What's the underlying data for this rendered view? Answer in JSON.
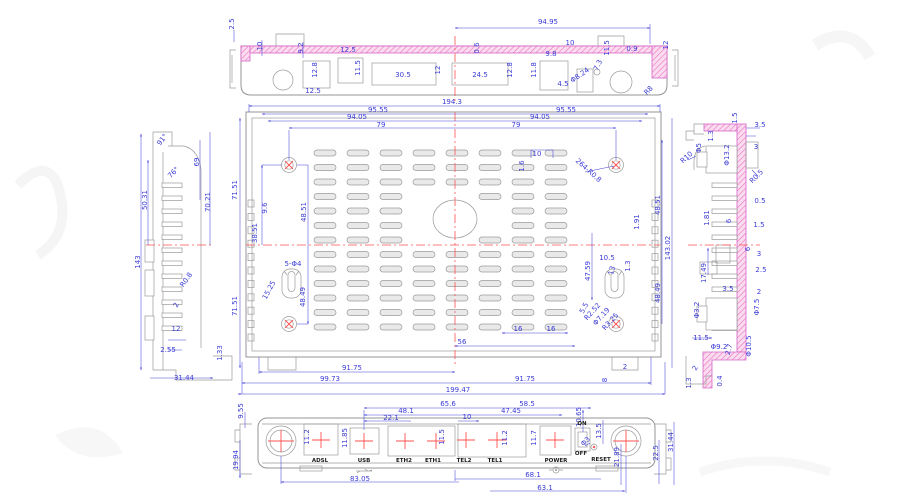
{
  "drawing_title": "router-enclosure-multiview-cad-drawing",
  "colors": {
    "dimension": "#3b3bd6",
    "outline": "#9a9a9a",
    "section_hatch": "#e86ac4",
    "centerline": "#ff5252"
  },
  "views": {
    "top_view": {
      "labels": [
        {
          "t": "2.5",
          "x": 234,
          "y": 24,
          "r": -90
        },
        {
          "t": "10",
          "x": 262,
          "y": 46,
          "r": -90
        },
        {
          "t": "9.2",
          "x": 303,
          "y": 48,
          "r": -90
        },
        {
          "t": "12.5",
          "x": 348,
          "y": 52
        },
        {
          "t": "12.8",
          "x": 317,
          "y": 70,
          "r": -90
        },
        {
          "t": "12.5",
          "x": 313,
          "y": 93
        },
        {
          "t": "11.5",
          "x": 360,
          "y": 68,
          "r": -90
        },
        {
          "t": "30.5",
          "x": 403,
          "y": 77
        },
        {
          "t": "12",
          "x": 440,
          "y": 70,
          "r": -90
        },
        {
          "t": "24.5",
          "x": 480,
          "y": 77
        },
        {
          "t": "12.8",
          "x": 512,
          "y": 70,
          "r": -90
        },
        {
          "t": "0.6",
          "x": 479,
          "y": 48,
          "r": -90
        },
        {
          "t": "94.95",
          "x": 548,
          "y": 24
        },
        {
          "t": "10",
          "x": 570,
          "y": 45
        },
        {
          "t": "9.8",
          "x": 551,
          "y": 56
        },
        {
          "t": "11.8",
          "x": 536,
          "y": 70,
          "r": -90
        },
        {
          "t": "11.5",
          "x": 609,
          "y": 48,
          "r": -90
        },
        {
          "t": "0.9",
          "x": 632,
          "y": 51
        },
        {
          "t": "12",
          "x": 668,
          "y": 45,
          "r": -90
        },
        {
          "t": "7.3",
          "x": 600,
          "y": 66,
          "r": -65
        },
        {
          "t": "4.5",
          "x": 563,
          "y": 86
        },
        {
          "t": "Φ8.24",
          "x": 581,
          "y": 77,
          "r": -35
        },
        {
          "t": "R8",
          "x": 650,
          "y": 92,
          "r": -45
        }
      ]
    },
    "main_view": {
      "labels": [
        {
          "t": "194.3",
          "x": 452,
          "y": 104
        },
        {
          "t": "95.55",
          "x": 378,
          "y": 112
        },
        {
          "t": "95.55",
          "x": 566,
          "y": 112
        },
        {
          "t": "94.05",
          "x": 357,
          "y": 119
        },
        {
          "t": "94.05",
          "x": 540,
          "y": 119
        },
        {
          "t": "79",
          "x": 381,
          "y": 127
        },
        {
          "t": "79",
          "x": 516,
          "y": 127
        },
        {
          "t": "10",
          "x": 537,
          "y": 156
        },
        {
          "t": "1.6",
          "x": 524,
          "y": 166,
          "r": -90
        },
        {
          "t": "264-R0.8",
          "x": 587,
          "y": 172,
          "r": 42
        },
        {
          "t": "71.51",
          "x": 237,
          "y": 190,
          "r": -90
        },
        {
          "t": "71.51",
          "x": 237,
          "y": 306,
          "r": -90
        },
        {
          "t": "9.6",
          "x": 267,
          "y": 208,
          "r": -90
        },
        {
          "t": "38.51",
          "x": 257,
          "y": 233,
          "r": -90
        },
        {
          "t": "48.51",
          "x": 306,
          "y": 212,
          "r": -90
        },
        {
          "t": "15.25",
          "x": 271,
          "y": 291,
          "r": -62
        },
        {
          "t": "5-Φ4",
          "x": 293,
          "y": 266
        },
        {
          "t": "48.49",
          "x": 305,
          "y": 297,
          "r": -90
        },
        {
          "t": "1.91",
          "x": 639,
          "y": 222,
          "r": -90
        },
        {
          "t": "48.51",
          "x": 660,
          "y": 205,
          "r": -90
        },
        {
          "t": "143.02",
          "x": 670,
          "y": 248,
          "r": -90
        },
        {
          "t": "48.49",
          "x": 660,
          "y": 293,
          "r": -90
        },
        {
          "t": "1.3",
          "x": 630,
          "y": 266,
          "r": -90
        },
        {
          "t": "10.5",
          "x": 607,
          "y": 260
        },
        {
          "t": "13",
          "x": 614,
          "y": 271,
          "r": -75
        },
        {
          "t": "47.59",
          "x": 590,
          "y": 271,
          "r": -90
        },
        {
          "t": "5.5",
          "x": 586,
          "y": 309,
          "r": -62
        },
        {
          "t": "R2.52",
          "x": 594,
          "y": 313,
          "r": -48
        },
        {
          "t": "Φ7.19",
          "x": 603,
          "y": 318,
          "r": -48
        },
        {
          "t": "R3.25",
          "x": 612,
          "y": 323,
          "r": -48
        },
        {
          "t": "16",
          "x": 518,
          "y": 331
        },
        {
          "t": "16",
          "x": 551,
          "y": 331
        },
        {
          "t": "56",
          "x": 462,
          "y": 344
        },
        {
          "t": "91.75",
          "x": 352,
          "y": 370
        },
        {
          "t": "99.73",
          "x": 330,
          "y": 381
        },
        {
          "t": "91.75",
          "x": 525,
          "y": 381
        },
        {
          "t": "199.47",
          "x": 458,
          "y": 392
        },
        {
          "t": "8",
          "x": 607,
          "y": 380,
          "r": -90
        },
        {
          "t": "2",
          "x": 625,
          "y": 369
        }
      ]
    },
    "left_view": {
      "labels": [
        {
          "t": "143",
          "x": 140,
          "y": 262,
          "r": -90
        },
        {
          "t": "91°",
          "x": 164,
          "y": 141,
          "r": -52
        },
        {
          "t": "69",
          "x": 199,
          "y": 162,
          "r": -90
        },
        {
          "t": "70.21",
          "x": 210,
          "y": 202,
          "r": -90
        },
        {
          "t": "50.31",
          "x": 147,
          "y": 200,
          "r": -90
        },
        {
          "t": "76°",
          "x": 175,
          "y": 174,
          "r": -45
        },
        {
          "t": "R0.8",
          "x": 188,
          "y": 281,
          "r": -55
        },
        {
          "t": "2",
          "x": 178,
          "y": 306,
          "r": -62
        },
        {
          "t": "12",
          "x": 176,
          "y": 331
        },
        {
          "t": "2.55",
          "x": 168,
          "y": 352
        },
        {
          "t": "1.33",
          "x": 222,
          "y": 353,
          "r": -90
        },
        {
          "t": "31.44",
          "x": 184,
          "y": 380
        }
      ]
    },
    "right_view": {
      "labels": [
        {
          "t": "1.5",
          "x": 737,
          "y": 118,
          "r": -90
        },
        {
          "t": "3.5",
          "x": 760,
          "y": 127
        },
        {
          "t": "1.3",
          "x": 713,
          "y": 136,
          "r": -90
        },
        {
          "t": "Φ5",
          "x": 701,
          "y": 148,
          "r": -90
        },
        {
          "t": "Φ13.2",
          "x": 729,
          "y": 155,
          "r": -90
        },
        {
          "t": "3",
          "x": 756,
          "y": 149
        },
        {
          "t": "R10",
          "x": 688,
          "y": 159,
          "r": -42
        },
        {
          "t": "R0.5",
          "x": 758,
          "y": 178,
          "r": -45
        },
        {
          "t": "0.5",
          "x": 760,
          "y": 203
        },
        {
          "t": "1.81",
          "x": 709,
          "y": 218,
          "r": -90
        },
        {
          "t": "6",
          "x": 731,
          "y": 221,
          "r": -90
        },
        {
          "t": "1.5",
          "x": 759,
          "y": 227
        },
        {
          "t": "6",
          "x": 750,
          "y": 249,
          "r": -90
        },
        {
          "t": "3",
          "x": 759,
          "y": 256
        },
        {
          "t": "17.49",
          "x": 706,
          "y": 273,
          "r": -90
        },
        {
          "t": "2.5",
          "x": 761,
          "y": 272
        },
        {
          "t": "3.5",
          "x": 728,
          "y": 291
        },
        {
          "t": "2",
          "x": 759,
          "y": 294
        },
        {
          "t": "Φ3.2",
          "x": 699,
          "y": 310,
          "r": -90
        },
        {
          "t": "Φ7.5",
          "x": 759,
          "y": 307,
          "r": -90
        },
        {
          "t": "11.5",
          "x": 701,
          "y": 340
        },
        {
          "t": "Φ9.2",
          "x": 719,
          "y": 349
        },
        {
          "t": "2.7",
          "x": 731,
          "y": 350,
          "r": -75
        },
        {
          "t": "Φ10.5",
          "x": 751,
          "y": 346,
          "r": -90
        },
        {
          "t": "2",
          "x": 697,
          "y": 369,
          "r": -62
        },
        {
          "t": "1.3",
          "x": 691,
          "y": 383,
          "r": -90
        },
        {
          "t": "0.4",
          "x": 722,
          "y": 381,
          "r": -90
        }
      ]
    },
    "bottom_view": {
      "labels": [
        {
          "t": "9.55",
          "x": 243,
          "y": 411,
          "r": -90
        },
        {
          "t": "65.6",
          "x": 448,
          "y": 406
        },
        {
          "t": "48.1",
          "x": 406,
          "y": 413
        },
        {
          "t": "22.1",
          "x": 391,
          "y": 420
        },
        {
          "t": "10",
          "x": 467,
          "y": 419
        },
        {
          "t": "58.5",
          "x": 527,
          "y": 406
        },
        {
          "t": "47.45",
          "x": 511,
          "y": 413
        },
        {
          "t": "10.65",
          "x": 581,
          "y": 417,
          "r": -90
        },
        {
          "t": "11.2",
          "x": 309,
          "y": 437,
          "r": -90
        },
        {
          "t": "11.85",
          "x": 347,
          "y": 438,
          "r": -90
        },
        {
          "t": "11.5",
          "x": 444,
          "y": 437,
          "r": -90
        },
        {
          "t": "11.2",
          "x": 507,
          "y": 438,
          "r": -90
        },
        {
          "t": "11.7",
          "x": 536,
          "y": 438,
          "r": -90
        },
        {
          "t": "13.5",
          "x": 601,
          "y": 431,
          "r": -90
        },
        {
          "t": "Φ3",
          "x": 587,
          "y": 443,
          "r": -45
        },
        {
          "t": "21.89",
          "x": 619,
          "y": 457,
          "r": -90
        },
        {
          "t": "22.5",
          "x": 658,
          "y": 453,
          "r": -90
        },
        {
          "t": "31.44",
          "x": 673,
          "y": 442,
          "r": -90
        },
        {
          "t": "19.94",
          "x": 238,
          "y": 460,
          "r": -90
        },
        {
          "t": "83.05",
          "x": 360,
          "y": 481
        },
        {
          "t": "68.1",
          "x": 533,
          "y": 477
        },
        {
          "t": "63.1",
          "x": 545,
          "y": 490
        }
      ],
      "ports": [
        {
          "t": "ADSL",
          "x": 320,
          "y": 462
        },
        {
          "t": "USB",
          "x": 364,
          "y": 462
        },
        {
          "t": "ETH2",
          "x": 404,
          "y": 462
        },
        {
          "t": "ETH1",
          "x": 433,
          "y": 462
        },
        {
          "t": "TEL2",
          "x": 464,
          "y": 462
        },
        {
          "t": "TEL1",
          "x": 495,
          "y": 462
        },
        {
          "t": "POWER",
          "x": 556,
          "y": 462
        },
        {
          "t": "RESET",
          "x": 601,
          "y": 461
        },
        {
          "t": "ON",
          "x": 582,
          "y": 425
        },
        {
          "t": "OFF",
          "x": 581,
          "y": 455
        }
      ]
    }
  }
}
